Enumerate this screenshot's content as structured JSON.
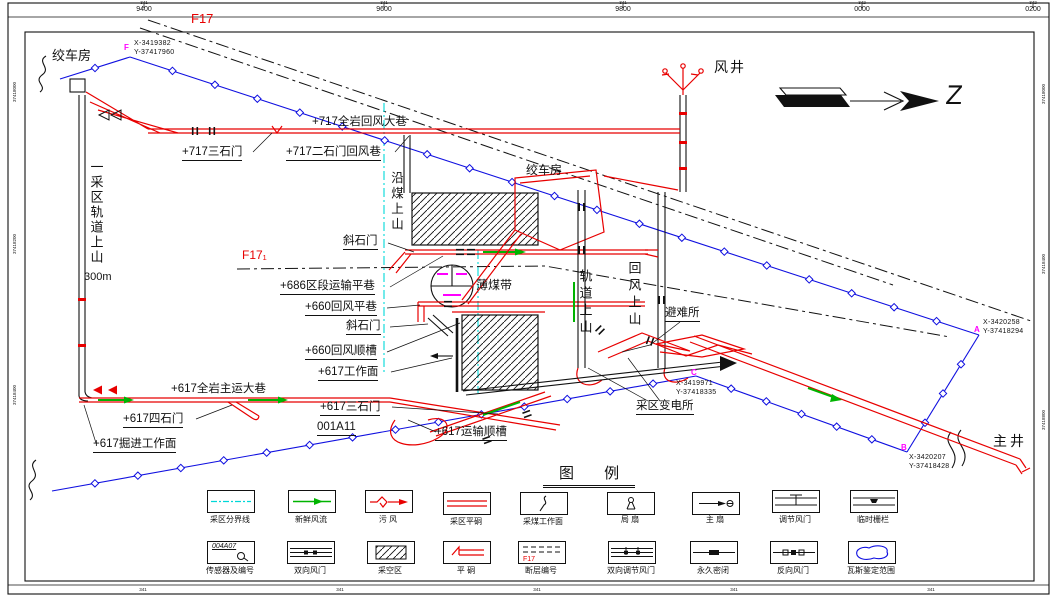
{
  "colors": {
    "roadway_red": "#e80000",
    "boundary_blue": "#1010e0",
    "fresh_air_green": "#00b400",
    "district_cyan": "#00d8d8",
    "point_magenta": "#ff00ff",
    "line_black": "#111111"
  },
  "frame": {
    "top_ticks": [
      {
        "prefix": "341",
        "value": "9400"
      },
      {
        "prefix": "341",
        "value": "9600"
      },
      {
        "prefix": "341",
        "value": "9800"
      },
      {
        "prefix": "342",
        "value": "0000"
      },
      {
        "prefix": "342",
        "value": "0200"
      }
    ],
    "bottom_ticks": [
      {
        "prefix": "341"
      },
      {
        "prefix": "341"
      },
      {
        "prefix": "341"
      },
      {
        "prefix": "341"
      },
      {
        "prefix": "341"
      }
    ],
    "left_labels": [
      "37418000",
      "37418200",
      "37418400"
    ],
    "right_labels": [
      "37418000",
      "37418400",
      "37418800"
    ]
  },
  "compass": {
    "letter": "Z"
  },
  "map": {
    "labels": {
      "fault_f17": "F17",
      "fault_f17_1": "F17₁",
      "wind_shaft": "风井",
      "winch_house_top": "绞车房",
      "winch_house_mid": "绞车房",
      "rw_717_main_return": "+717全岩回风大巷",
      "rw_717_sanshimen": "+717三石门",
      "rw_717_ershimen": "+717二石门回风巷",
      "district_rail_rise": "一采区轨道上山",
      "rail_rise_length": "300m",
      "coal_rise": "沿煤上山",
      "xieshimen_upper": "斜石门",
      "rw_686_transport": "+686区段运输平巷",
      "thin_coal_belt": "薄煤带",
      "rw_660_return_level": "+660回风平巷",
      "xieshimen_lower": "斜石门",
      "rw_660_return_gateway": "+660回风顺槽",
      "rw_617_workface": "+617工作面",
      "rw_617_main_haul": "+617全岩主运大巷",
      "rw_617_sanshimen": "+617三石门",
      "workface_id": "001A11",
      "rw_617_sishimen": "+617四石门",
      "rw_617_heading_face": "+617掘进工作面",
      "rw_617_transport_gateway": "+617运输顺槽",
      "track_rise": "轨道上山",
      "return_rise": "回风上山",
      "refuge_chamber": "避难所",
      "district_substation": "采区变电所",
      "main_shaft": "主井"
    },
    "points": {
      "F": {
        "id": "F",
        "x": "X-3419382",
        "y": "Y-37417960"
      },
      "A": {
        "id": "A",
        "x": "X-3420258",
        "y": "Y-37418294"
      },
      "B": {
        "id": "B",
        "x": "X-3420207",
        "y": "Y-37418428"
      },
      "C": {
        "id": "C",
        "x": "X-3419971",
        "y": "Y-37418335"
      }
    }
  },
  "legend": {
    "title": "图 例",
    "sensor_code": "004A07",
    "fault_code": "F17",
    "row1": [
      "采区分界线",
      "新鲜风流",
      "污  风",
      "采区平硐",
      "采煤工作面",
      "局  扇",
      "主  扇",
      "调节风门",
      "临时栅栏"
    ],
    "row2": [
      "传感器及编号",
      "双向风门",
      "采空区",
      "平  硐",
      "断层编号",
      "双向调节风门",
      "永久密闭",
      "反向风门",
      "瓦斯鉴定范围"
    ]
  }
}
